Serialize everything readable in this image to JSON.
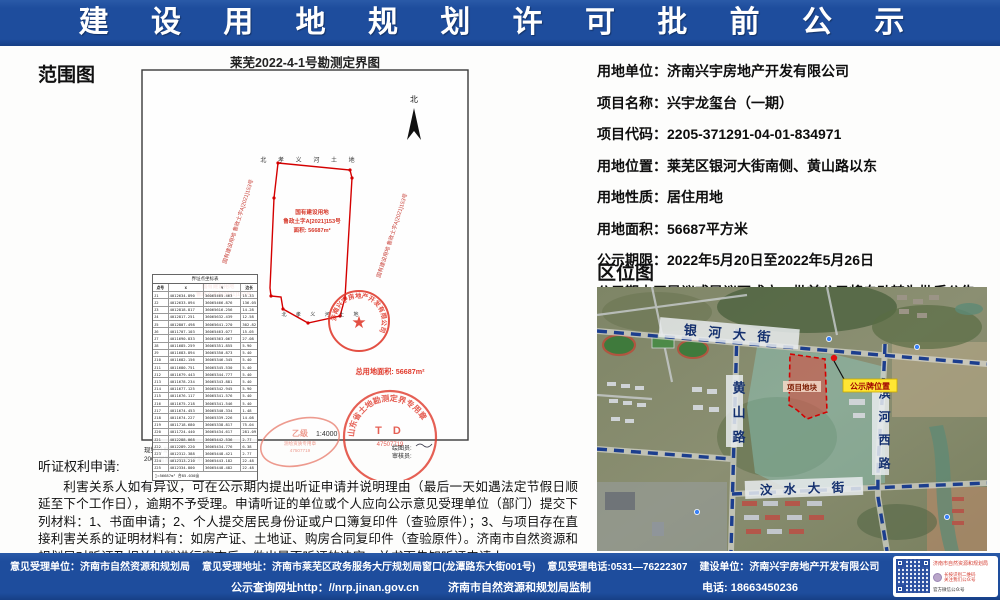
{
  "header": {
    "title": "建 设 用 地 规 划 许 可 批 前 公 示"
  },
  "scope_map": {
    "section_label": "范围图",
    "map_title": "莱芜2022-4-1号勘测定界图",
    "north_label": "北",
    "top_road_label": "北 孝 义 河 土 地",
    "bottom_road_label": "北 孝 义 河 土 地",
    "parcel_text": {
      "line1": "国有建设用地",
      "line2": "鲁政土字A[2021]153号",
      "line3": "面积: 56687m²"
    },
    "side_label_left": "国有建设用地 鲁政土字A[2021]153号",
    "side_label_right": "国有建设用地 鲁政土字A[2021]153号",
    "corner_label_line1": "国有建设用地",
    "corner_label_line2": "鲁政土字A[2021]153号",
    "total_area_label": "总用地面积: 56687m²",
    "company_stamp_text": "济南兴宇房地产开发有限公司",
    "survey_stamp_text": "山东省土地勘测定界专用章",
    "survey_stamp_code": "T D",
    "survey_stamp_no": "47507719",
    "grade_stamp_text": "乙级",
    "grade_stamp_sub": "测绘资质专用章",
    "scale_label": "1:4000",
    "drafter_label": "绘图员:",
    "checker_label": "审核员:",
    "datum_line1": "现势日期:",
    "datum_line2": "2000国家大地坐标系",
    "coord_table": {
      "title": "界址点坐标表",
      "headers": [
        "点号",
        "X",
        "Y",
        "边长"
      ],
      "rows": [
        [
          "J1",
          "4012634.890",
          "36065465.463",
          "15.33"
        ],
        [
          "J2",
          "4012633.094",
          "36065466.876",
          "136.05"
        ],
        [
          "J3",
          "4012818.817",
          "36065616.256",
          "14.28"
        ],
        [
          "J4",
          "4012817.251",
          "36065632.439",
          "12.58"
        ],
        [
          "J5",
          "4012807.498",
          "36065641.270",
          "302.82"
        ],
        [
          "J6",
          "4011707.103",
          "36065463.077",
          "15.05"
        ],
        [
          "J7",
          "4011690.833",
          "36065363.067",
          "27.08"
        ],
        [
          "J8",
          "4011685.259",
          "36065351.855",
          "5.90"
        ],
        [
          "J9",
          "4011683.894",
          "36065350.873",
          "5.40"
        ],
        [
          "J10",
          "4011682.156",
          "36065346.345",
          "5.40"
        ],
        [
          "J11",
          "4011680.751",
          "36065345.530",
          "5.40"
        ],
        [
          "J12",
          "4011679.443",
          "36065344.777",
          "5.40"
        ],
        [
          "J13",
          "4011678.234",
          "36065343.881",
          "5.40"
        ],
        [
          "J14",
          "4011677.125",
          "36065342.945",
          "5.90"
        ],
        [
          "J15",
          "4011676.117",
          "36065341.576",
          "5.40"
        ],
        [
          "J16",
          "4011675.218",
          "36065341.546",
          "5.40"
        ],
        [
          "J17",
          "4011674.453",
          "36065340.334",
          "1.48"
        ],
        [
          "J18",
          "4011674.227",
          "36065339.226",
          "14.08"
        ],
        [
          "J19",
          "4011718.680",
          "36065338.817",
          "75.04"
        ],
        [
          "J20",
          "4011724.440",
          "36065434.617",
          "281.09"
        ],
        [
          "J21",
          "4012288.068",
          "36065442.536",
          "2.77"
        ],
        [
          "J22",
          "4012289.220",
          "36065434.776",
          "6.38"
        ],
        [
          "J23",
          "4012312.388",
          "36065448.421",
          "2.77"
        ],
        [
          "J24",
          "4012313.210",
          "36065443.182",
          "22.48"
        ],
        [
          "J25",
          "4012334.800",
          "36065448.482",
          "22.48"
        ]
      ],
      "sum": "∑=56687m²  合85.030亩"
    }
  },
  "info": {
    "rows": [
      {
        "label": "用地单位：",
        "value": "济南兴宇房地产开发有限公司"
      },
      {
        "label": "项目名称：",
        "value": "兴宇龙玺台（一期）"
      },
      {
        "label": "项目代码：",
        "value": "2205-371291-04-01-834971"
      },
      {
        "label": "用地位置：",
        "value": "莱芜区银河大街南侧、黄山路以东"
      },
      {
        "label": "用地性质：",
        "value": "居住用地"
      },
      {
        "label": "用地面积：",
        "value": "56687平方米"
      },
      {
        "label": "公示期限：",
        "value": "2022年5月20日至2022年5月26日"
      }
    ],
    "note": "公示期内无异议或异议不成立，批前公示将自动转为批后公告。"
  },
  "location_map": {
    "section_label": "区位图",
    "road_north": "银 河 大 街",
    "road_west": "黄 山 路",
    "road_east": "滨 河 西 路",
    "road_south": "汶 水 大 街",
    "plot_label": "项目地块",
    "board_label": "公示牌位置"
  },
  "hearing": {
    "title": "听证权利申请:",
    "body": "利害关系人如有异议，可在公示期内提出听证申请并说明理由（最后一天如遇法定节假日顺延至下个工作日），逾期不予受理。申请听证的单位或个人应向公示意见受理单位（部门）提交下列材料：1、书面申请；2、个人提交居民身份证或户口簿复印件（查验原件）；3、与项目存在直接利害关系的证明材料有：如房产证、土地证、购房合同复印件（查验原件）。济南市自然资源和规划局对听证及相关材料进行审查后，做出是否听证的决定，并书面告知听证申请人。"
  },
  "footer": {
    "line1_items": [
      "意见受理单位：济南市自然资源和规划局",
      "意见受理地址：济南市莱芜区政务服务大厅规划局窗口(龙潭路东大街001号)",
      "意见受理电话:0531—76222307",
      "建设单位：济南兴宇房地产开发有限公司"
    ],
    "line2": {
      "url": "公示查询网址http：//nrp.jinan.gov.cn",
      "producer": "济南市自然资源和规划局监制",
      "phone": "电话: 18663450236"
    },
    "qr": {
      "title": "济南市自然资源和规划局",
      "tip1": "长按识别二维码",
      "tip2": "关注我们公众号",
      "caption": "官方微信公众号"
    },
    "accent_blue": "#1e4d9d",
    "stamp_red": "#d6392b"
  }
}
